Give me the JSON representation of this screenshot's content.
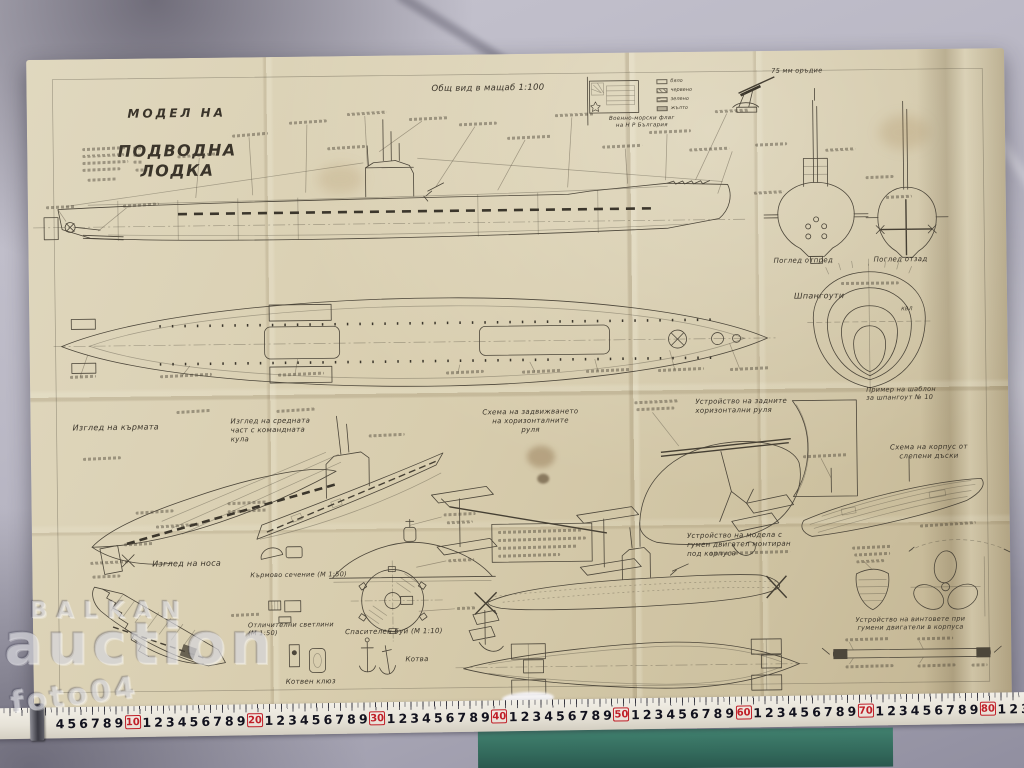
{
  "watermark": {
    "brand_top": "BALKAN",
    "brand_main": "auction",
    "photo_id": "foto04"
  },
  "sheet": {
    "title_line1": "МОДЕЛ НА",
    "title_line2": "ПОДВОДНА ЛОДКА",
    "scale_note": "Общ вид в мащаб 1:100",
    "gun_caption": "75 мм оръдие",
    "flag_caption": "Военно-морски флаг\nна Н Р България",
    "flag_legend": [
      "бяло",
      "червено",
      "зелено",
      "жълто"
    ],
    "view_front": "Поглед отпред",
    "view_aft": "Поглед отзад",
    "frames_label": "Шпангоути",
    "kvl_label": "КВЛ",
    "frame_template": "Пример на шаблон\nза шпангоут № 10",
    "stern_view": "Изглед на кърмата",
    "midship_view": "Изглед на средната\nчаст с командната\nкула",
    "planes_scheme": "Схема на задвижването\nна хоризонталните\nруля",
    "aft_planes": "Устройство на задните\nхоризонтални руля",
    "glued_hull": "Схема на корпус от\nслепени дъски",
    "bow_view": "Изглед на носа",
    "stern_section": "Кърмово сечение (М 1:50)",
    "lights_section": "Отличителни светлини\n(М 1:50)",
    "buoy_label": "Спасителен буй (М 1:10)",
    "hawse_label": "Котвен клюз",
    "anchor_label": "Котва",
    "rubber_motor": "Устройство на модела с\nгумен двигател монтиран\nпод корпуса",
    "prop_device": "Устройство на винтовете при\nгумени двигатели в корпуса"
  },
  "ruler": {
    "lead_digits": [
      "4",
      "5",
      "6",
      "7",
      "8",
      "9"
    ],
    "unit_digits": [
      "1",
      "2",
      "3",
      "4",
      "5",
      "6",
      "7",
      "8",
      "9"
    ],
    "decades": [
      "10",
      "20",
      "30",
      "40",
      "50",
      "60",
      "70",
      "80"
    ],
    "tail_digits": [
      "1",
      "2",
      "3",
      "4",
      "5"
    ]
  }
}
